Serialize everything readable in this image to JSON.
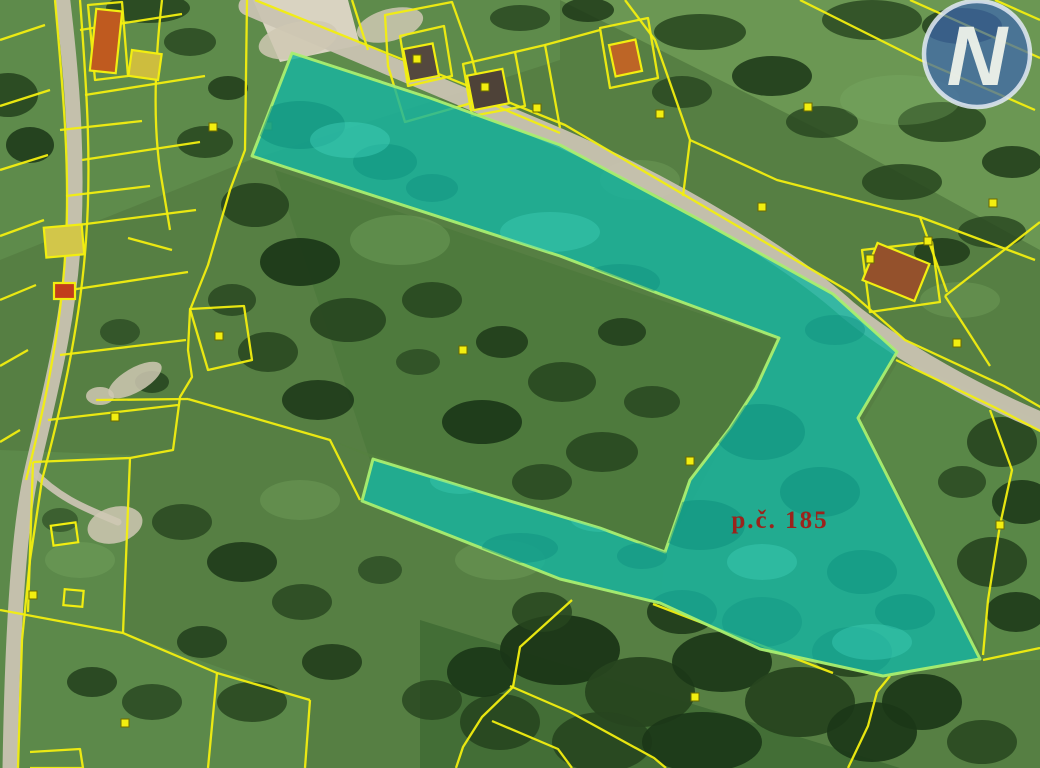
{
  "map": {
    "width": 1040,
    "height": 768,
    "palette": {
      "base": "#567f43",
      "line": "#f2ee10",
      "line_dark": "#6b6b00",
      "road": "#c9c3b1",
      "pad": "#cfc8b3",
      "trees": [
        "#27451f",
        "#1b3617",
        "#33582a",
        "#7fae66"
      ],
      "highlight_fill": "#17b4a1",
      "highlight_stroke": "#a9ee70",
      "shadow_dark": "#0c8d7c",
      "shadow_light": "#45d6c0",
      "label_color": "#9b231c",
      "logo_blue": "#3d66ae",
      "logo_ring": "#e3eaf4",
      "logo_letter_color": "#eef2ea",
      "marker_fill": "#f2ee10"
    },
    "fields": [
      {
        "points": "560,0 1040,0 1040,250 830,135",
        "fill": "#6e9a55",
        "op": 0.9
      },
      {
        "points": "0,0 560,0 560,60 250,160 0,260",
        "fill": "#63904f",
        "op": 0.7
      },
      {
        "points": "275,170 778,340 665,552 370,460",
        "fill": "#4e7a3d",
        "op": 0.9
      },
      {
        "points": "900,358 1040,422 1040,660 985,660 862,422",
        "fill": "#5a8848",
        "op": 0.9
      },
      {
        "points": "0,450 130,455 123,633 310,700 305,768 0,768",
        "fill": "#5e8c4c",
        "op": 0.8
      },
      {
        "points": "330,440 665,555 660,605 560,580 362,502 372,458",
        "fill": "#55803f",
        "op": 0.6
      },
      {
        "points": "420,620 900,768 420,768",
        "fill": "#3f6a33",
        "op": 0.8
      }
    ],
    "trees": [
      [
        8,
        95,
        30,
        22,
        0.9,
        0
      ],
      [
        30,
        145,
        24,
        18,
        0.85,
        1
      ],
      [
        148,
        8,
        42,
        15,
        0.9,
        0
      ],
      [
        190,
        42,
        26,
        14,
        0.8,
        0
      ],
      [
        228,
        88,
        20,
        12,
        0.8,
        1
      ],
      [
        205,
        142,
        28,
        16,
        0.85,
        0
      ],
      [
        255,
        205,
        34,
        22,
        0.9,
        0
      ],
      [
        300,
        262,
        40,
        24,
        0.9,
        1
      ],
      [
        348,
        320,
        38,
        22,
        0.9,
        0
      ],
      [
        268,
        352,
        30,
        20,
        0.85,
        0
      ],
      [
        318,
        400,
        36,
        20,
        0.85,
        1
      ],
      [
        232,
        300,
        24,
        16,
        0.8,
        0
      ],
      [
        120,
        332,
        20,
        13,
        0.7,
        0
      ],
      [
        152,
        382,
        17,
        11,
        0.7,
        1
      ],
      [
        520,
        18,
        30,
        13,
        0.8,
        0
      ],
      [
        588,
        10,
        26,
        12,
        0.8,
        1
      ],
      [
        700,
        32,
        46,
        18,
        0.85,
        0
      ],
      [
        772,
        76,
        40,
        20,
        0.85,
        1
      ],
      [
        682,
        92,
        30,
        16,
        0.8,
        0
      ],
      [
        872,
        20,
        50,
        20,
        0.8,
        0
      ],
      [
        962,
        26,
        40,
        18,
        0.75,
        1
      ],
      [
        822,
        122,
        36,
        16,
        0.8,
        0
      ],
      [
        942,
        122,
        44,
        20,
        0.85,
        0
      ],
      [
        1012,
        162,
        30,
        16,
        0.8,
        1
      ],
      [
        902,
        182,
        40,
        18,
        0.85,
        0
      ],
      [
        992,
        232,
        34,
        16,
        0.8,
        0
      ],
      [
        942,
        252,
        28,
        14,
        0.8,
        1
      ],
      [
        432,
        300,
        30,
        18,
        0.85,
        0
      ],
      [
        502,
        342,
        26,
        16,
        0.8,
        1
      ],
      [
        562,
        382,
        34,
        20,
        0.85,
        0
      ],
      [
        482,
        422,
        40,
        22,
        0.9,
        1
      ],
      [
        602,
        452,
        36,
        20,
        0.85,
        0
      ],
      [
        542,
        482,
        30,
        18,
        0.8,
        0
      ],
      [
        622,
        332,
        24,
        14,
        0.75,
        1
      ],
      [
        652,
        402,
        28,
        16,
        0.8,
        0
      ],
      [
        418,
        362,
        22,
        13,
        0.7,
        0
      ],
      [
        560,
        650,
        60,
        35,
        0.95,
        1
      ],
      [
        640,
        692,
        55,
        35,
        0.95,
        0
      ],
      [
        722,
        662,
        50,
        30,
        0.9,
        1
      ],
      [
        800,
        702,
        55,
        35,
        0.95,
        0
      ],
      [
        872,
        732,
        45,
        30,
        0.9,
        1
      ],
      [
        500,
        722,
        40,
        28,
        0.9,
        0
      ],
      [
        602,
        742,
        50,
        30,
        0.9,
        0
      ],
      [
        702,
        742,
        60,
        30,
        0.9,
        1
      ],
      [
        762,
        622,
        40,
        25,
        0.9,
        0
      ],
      [
        682,
        612,
        35,
        22,
        0.85,
        1
      ],
      [
        542,
        612,
        30,
        20,
        0.85,
        0
      ],
      [
        482,
        672,
        35,
        25,
        0.9,
        1
      ],
      [
        852,
        652,
        40,
        25,
        0.9,
        0
      ],
      [
        922,
        702,
        40,
        28,
        0.9,
        1
      ],
      [
        982,
        742,
        35,
        22,
        0.85,
        0
      ],
      [
        432,
        700,
        30,
        20,
        0.8,
        0
      ],
      [
        1002,
        442,
        35,
        25,
        0.9,
        0
      ],
      [
        1022,
        502,
        30,
        22,
        0.85,
        1
      ],
      [
        992,
        562,
        35,
        25,
        0.9,
        0
      ],
      [
        1016,
        612,
        30,
        20,
        0.85,
        1
      ],
      [
        962,
        482,
        24,
        16,
        0.8,
        0
      ],
      [
        182,
        522,
        30,
        18,
        0.8,
        0
      ],
      [
        242,
        562,
        35,
        20,
        0.85,
        1
      ],
      [
        302,
        602,
        30,
        18,
        0.8,
        0
      ],
      [
        202,
        642,
        25,
        16,
        0.75,
        1
      ],
      [
        152,
        702,
        30,
        18,
        0.8,
        0
      ],
      [
        92,
        682,
        25,
        15,
        0.75,
        1
      ],
      [
        252,
        702,
        35,
        20,
        0.85,
        0
      ],
      [
        332,
        662,
        30,
        18,
        0.8,
        1
      ],
      [
        380,
        570,
        22,
        14,
        0.7,
        0
      ],
      [
        60,
        520,
        18,
        12,
        0.6,
        0
      ],
      [
        400,
        240,
        50,
        25,
        0.35,
        3
      ],
      [
        640,
        180,
        40,
        20,
        0.3,
        3
      ],
      [
        900,
        100,
        60,
        25,
        0.3,
        3
      ],
      [
        300,
        500,
        40,
        20,
        0.3,
        3
      ],
      [
        80,
        560,
        35,
        18,
        0.3,
        3
      ],
      [
        500,
        560,
        45,
        20,
        0.3,
        3
      ],
      [
        960,
        300,
        40,
        18,
        0.3,
        3
      ]
    ],
    "roads": [
      {
        "d": "M248,6 C340,45 470,100 560,138 C680,190 795,262 848,310 C902,354 980,396 1042,422",
        "w": 19
      },
      {
        "d": "M62,-6 C70,60 78,140 74,230 C70,320 48,400 32,470 C18,530 12,640 10,770",
        "w": 15
      },
      {
        "d": "M32,470 C60,500 90,510 118,522",
        "w": 7
      }
    ],
    "pads": [
      [
        115,
        525,
        28,
        18,
        -15
      ],
      [
        100,
        396,
        14,
        9,
        0
      ],
      [
        390,
        25,
        34,
        16,
        -15
      ],
      [
        298,
        40,
        40,
        18,
        -12
      ],
      [
        135,
        380,
        30,
        12,
        -30
      ]
    ],
    "yard": {
      "points": "253,0 348,0 360,45 280,62",
      "fill": "#d9d3c1"
    },
    "parcel_lines": [
      "M55,0 C62,80 70,160 66,240 C62,330 42,418 26,480",
      "M80,0 C86,80 92,160 86,240 C80,330 58,420 42,480 L30,560 L22,640 L18,768",
      "M80,30 L182,14",
      "M85,95 L205,76",
      "M82,160 L200,142",
      "M78,225 L196,210",
      "M70,290 L188,272",
      "M60,355 L186,340",
      "M48,420 L178,405",
      "M45,25 L0,40",
      "M50,90 L0,106",
      "M48,155 L0,170",
      "M44,220 L0,236",
      "M36,285 L0,300",
      "M28,350 L0,366",
      "M20,430 L0,442",
      "M162,0 C155,60 153,120 160,170 L170,230",
      "M247,0 L245,150 L230,190 L208,265 L190,310 L188,350 L192,377 L180,397 L173,450 L130,458",
      "M96,400 L188,399",
      "M128,238 L172,250",
      "M88,5 L122,2 L128,76 L95,80 Z",
      "M60,130 L142,121",
      "M66,196 L150,186",
      "M33,462 L130,458",
      "M33,462 L28,612",
      "M0,610 L123,633",
      "M123,633 L130,458",
      "M123,633 L217,673 L310,700",
      "M310,700 L305,768",
      "M217,673 L208,768",
      "M30,752 L80,749 L83,768 L30,768",
      "M255,0 L565,125 L850,292 L905,340 L1004,386 L1042,408",
      "M896,360 L996,408 L1042,432",
      "M352,0 L368,50",
      "M385,15 L452,2 L472,58 L482,100 L405,122 L388,66 Z",
      "M400,36 L444,26 L452,76 L408,86 Z",
      "M463,64 L515,52 L525,106 L472,116 Z",
      "M515,52 L545,45 L560,128",
      "M545,45 L600,30",
      "M600,28 L648,18 L658,78 L610,88 Z",
      "M482,100 L560,133",
      "M625,0 L655,40 L690,140",
      "M800,0 L920,60 L1035,110",
      "M910,0 L1040,58",
      "M690,140 L777,180 L920,217 L1035,260",
      "M690,140 L683,196",
      "M920,217 L947,292",
      "M945,296 L1040,222",
      "M945,296 L967,330 L990,366",
      "M990,410 L1012,470 L1000,525 L988,600 L983,655",
      "M983,660 L1040,648",
      "M890,676 L877,692 L868,726 L848,768",
      "M653,604 L833,673",
      "M572,600 L520,647 L513,687 L482,717 L463,747 L456,768",
      "M510,686 L570,712 L654,758 L666,768",
      "M492,721 L558,749 L572,768",
      "M188,399 L330,440 L360,500",
      "M190,309 L244,306 L252,360 L208,370 Z",
      "M995,0 L1040,20",
      "M862,250 L932,242 L940,302 L870,312 Z"
    ],
    "buildings": [
      [
        93,
        10,
        26,
        62,
        6,
        "#bf5a1f"
      ],
      [
        130,
        52,
        30,
        26,
        8,
        "#cdbd3e"
      ],
      [
        45,
        226,
        38,
        30,
        -5,
        "#d2c64a"
      ],
      [
        54,
        283,
        21,
        16,
        0,
        "#c23d1b"
      ],
      [
        406,
        46,
        30,
        33,
        -11,
        "#54483e"
      ],
      [
        470,
        72,
        36,
        35,
        -11,
        "#4e4238"
      ],
      [
        612,
        42,
        27,
        32,
        -12,
        "#bd6526"
      ],
      [
        868,
        252,
        56,
        40,
        22,
        "#94512c"
      ],
      [
        52,
        524,
        25,
        20,
        -8,
        "none"
      ],
      [
        64,
        590,
        19,
        16,
        5,
        "none"
      ]
    ],
    "markers": [
      [
        213,
        127
      ],
      [
        268,
        126
      ],
      [
        115,
        417
      ],
      [
        219,
        336
      ],
      [
        125,
        723
      ],
      [
        33,
        595
      ],
      [
        417,
        59
      ],
      [
        485,
        87
      ],
      [
        537,
        108
      ],
      [
        660,
        114
      ],
      [
        762,
        207
      ],
      [
        808,
        107
      ],
      [
        993,
        203
      ],
      [
        870,
        259
      ],
      [
        957,
        343
      ],
      [
        1000,
        525
      ],
      [
        695,
        697
      ],
      [
        463,
        350
      ],
      [
        690,
        461
      ],
      [
        928,
        241
      ]
    ],
    "highlight": {
      "points": "292,53 430,98 560,145 700,220 833,294 897,352 858,418 980,659 883,676 760,649 660,603 560,579 362,501 373,459 500,498 600,528 665,552 690,480 730,428 756,388 779,338 660,294 560,256 285,167 252,156",
      "fill_opacity": 0.82,
      "shadows": [
        [
          300,
          125,
          45,
          24,
          0.5,
          0
        ],
        [
          385,
          162,
          32,
          18,
          0.45,
          0
        ],
        [
          620,
          282,
          40,
          18,
          0.4,
          0
        ],
        [
          432,
          188,
          26,
          14,
          0.4,
          0
        ],
        [
          760,
          432,
          45,
          28,
          0.5,
          0
        ],
        [
          820,
          492,
          40,
          25,
          0.5,
          0
        ],
        [
          700,
          525,
          45,
          25,
          0.5,
          0
        ],
        [
          862,
          572,
          35,
          22,
          0.45,
          0
        ],
        [
          642,
          556,
          25,
          13,
          0.4,
          0
        ],
        [
          905,
          612,
          30,
          18,
          0.45,
          0
        ],
        [
          520,
          548,
          38,
          15,
          0.4,
          0
        ],
        [
          835,
          330,
          30,
          15,
          0.4,
          0
        ],
        [
          350,
          140,
          40,
          18,
          0.4,
          1
        ],
        [
          550,
          232,
          50,
          20,
          0.35,
          1
        ],
        [
          700,
          352,
          40,
          20,
          0.35,
          1
        ],
        [
          762,
          562,
          35,
          18,
          0.35,
          1
        ],
        [
          600,
          518,
          30,
          14,
          0.3,
          1
        ],
        [
          872,
          642,
          40,
          18,
          0.35,
          1
        ],
        [
          930,
          420,
          30,
          16,
          0.35,
          1
        ],
        [
          460,
          480,
          30,
          14,
          0.3,
          1
        ]
      ]
    },
    "label": {
      "text": "p.č. 185",
      "x": 780,
      "y": 528,
      "size": 25
    },
    "logo": {
      "letter": "N",
      "cx": 977,
      "cy": 54,
      "r": 53,
      "size": 84,
      "opacity": 0.72
    }
  }
}
